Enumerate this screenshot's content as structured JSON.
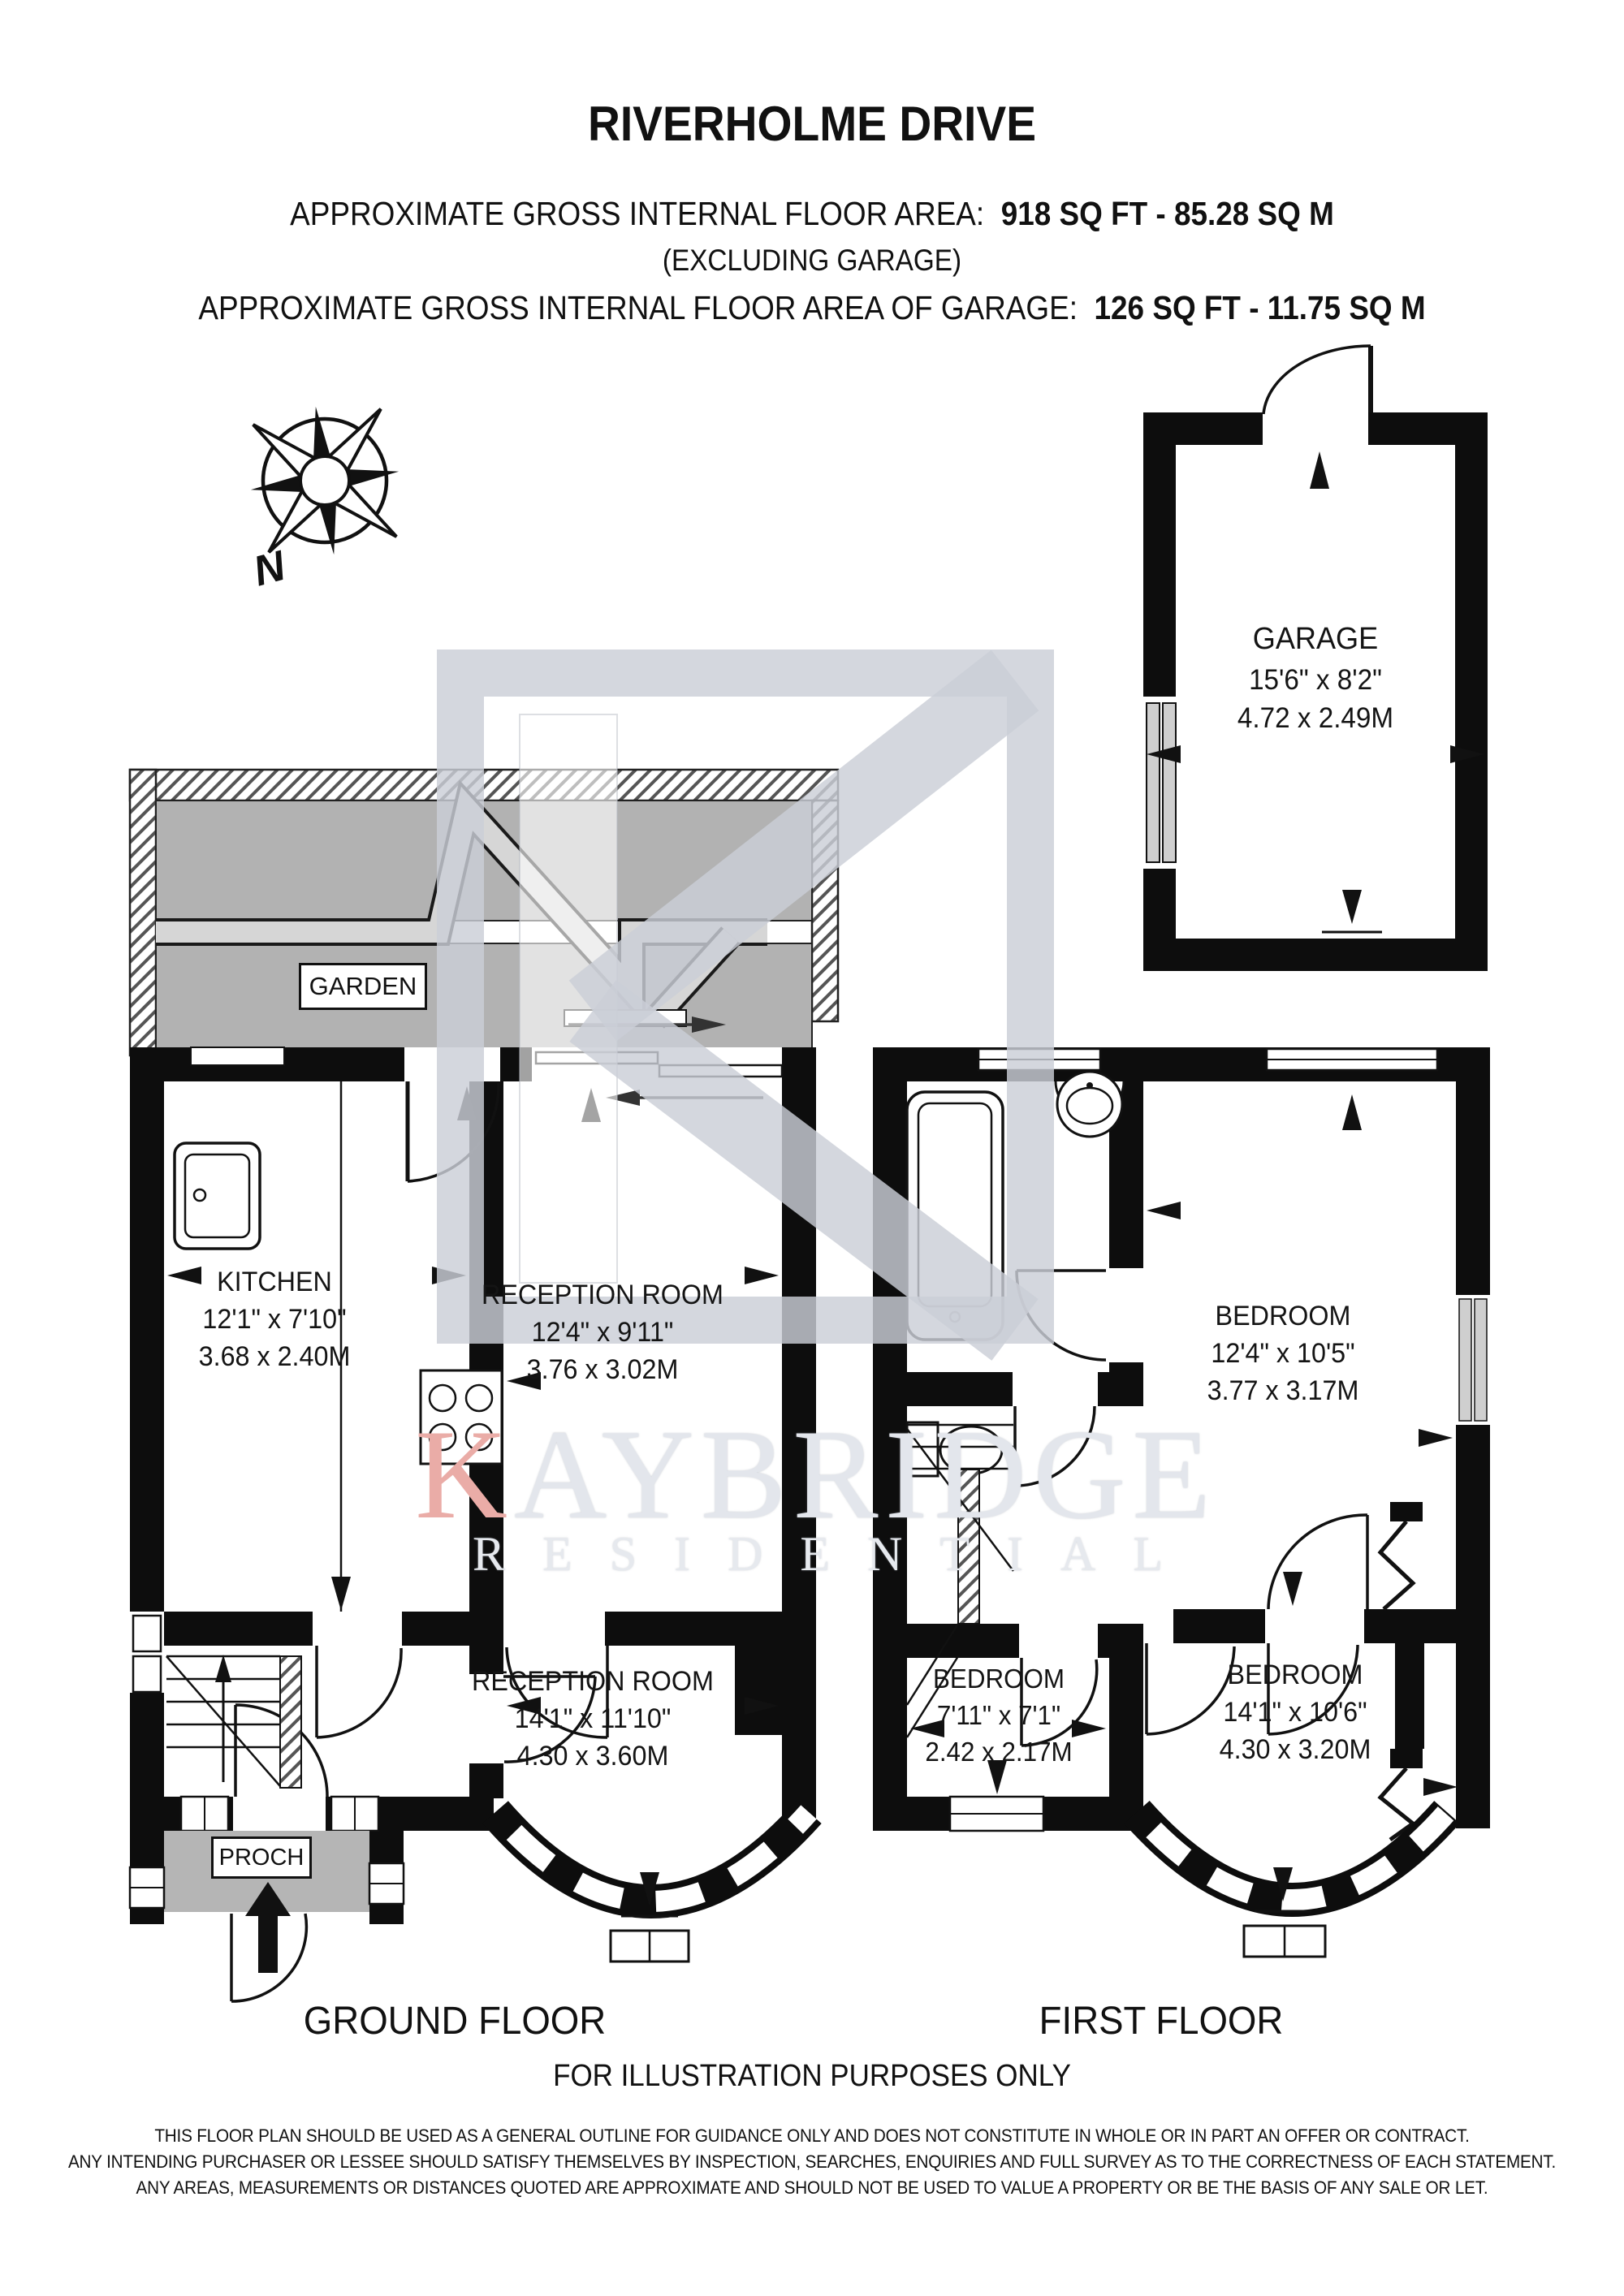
{
  "header": {
    "title": "RIVERHOLME DRIVE",
    "area_label": "APPROXIMATE GROSS INTERNAL FLOOR AREA:",
    "area_value": "918 SQ FT - 85.28 SQ M",
    "excluding": "(EXCLUDING GARAGE)",
    "garage_area_label": "APPROXIMATE GROSS INTERNAL FLOOR AREA OF GARAGE:",
    "garage_area_value": "126 SQ FT - 11.75 SQ M"
  },
  "compass": {
    "north_label": "N"
  },
  "garage": {
    "name": "GARAGE",
    "dims_imperial": "15'6\" x 8'2\"",
    "dims_metric": "4.72 x 2.49M"
  },
  "garden": {
    "label": "GARDEN"
  },
  "ground_floor": {
    "caption": "GROUND FLOOR",
    "kitchen": {
      "name": "KITCHEN",
      "dims_imperial": "12'1\" x 7'10\"",
      "dims_metric": "3.68 x 2.40M"
    },
    "reception_top": {
      "name": "RECEPTION ROOM",
      "dims_imperial": "12'4\" x 9'11\"",
      "dims_metric": "3.76 x 3.02M"
    },
    "reception_bottom": {
      "name": "RECEPTION ROOM",
      "dims_imperial": "14'1\" x 11'10\"",
      "dims_metric": "4.30 x 3.60M"
    },
    "porch": {
      "label": "PROCH"
    }
  },
  "first_floor": {
    "caption": "FIRST FLOOR",
    "bedroom_rear": {
      "name": "BEDROOM",
      "dims_imperial": "12'4\" x 10'5\"",
      "dims_metric": "3.77 x 3.17M"
    },
    "bedroom_small": {
      "name": "BEDROOM",
      "dims_imperial": "7'11\" x 7'1\"",
      "dims_metric": "2.42 x 2.17M"
    },
    "bedroom_front": {
      "name": "BEDROOM",
      "dims_imperial": "14'1\" x 10'6\"",
      "dims_metric": "4.30 x 3.20M"
    }
  },
  "watermark": {
    "brand_initial": "K",
    "brand_rest": "AYBRIDGE",
    "subtitle": "RESIDENTIAL",
    "accent_color": "#eaaca7"
  },
  "footer": {
    "illustration_note": "FOR ILLUSTRATION PURPOSES ONLY",
    "disclaimer_lines": [
      "THIS FLOOR PLAN SHOULD BE USED AS A GENERAL OUTLINE FOR GUIDANCE ONLY AND DOES NOT CONSTITUTE IN WHOLE OR IN PART AN OFFER OR CONTRACT.",
      "ANY INTENDING PURCHASER OR LESSEE SHOULD SATISFY THEMSELVES BY INSPECTION, SEARCHES, ENQUIRIES AND FULL SURVEY AS TO THE CORRECTNESS OF EACH STATEMENT.",
      "ANY AREAS, MEASUREMENTS OR DISTANCES QUOTED ARE APPROXIMATE AND SHOULD NOT BE USED TO VALUE A PROPERTY OR BE THE BASIS OF ANY SALE OR LET."
    ]
  },
  "colors": {
    "wall": "#0d0d0d",
    "garden_fill": "#b2b2b2",
    "watermark_gray": "#cbced7"
  }
}
